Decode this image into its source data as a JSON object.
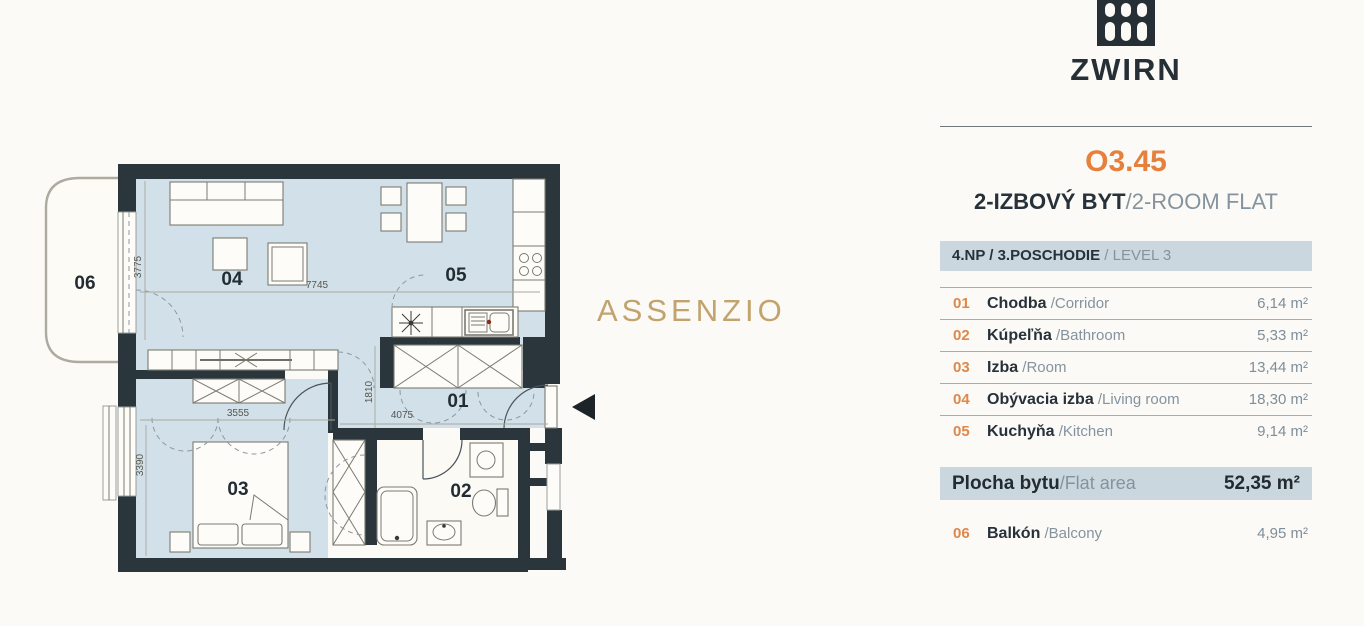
{
  "brand": {
    "name": "ZWIRN"
  },
  "unit": {
    "id": "O3.45",
    "type_sk": "2-IZBOVÝ BYT",
    "type_en": "/2-ROOM FLAT",
    "level_sk": "4.NP / 3.POSCHODIE",
    "level_en": " / LEVEL 3"
  },
  "rooms": [
    {
      "num": "01",
      "name_sk": "Chodba",
      "name_en": " /Corridor",
      "area": "6,14 m²"
    },
    {
      "num": "02",
      "name_sk": "Kúpeľňa",
      "name_en": " /Bathroom",
      "area": "5,33 m²"
    },
    {
      "num": "03",
      "name_sk": "Izba",
      "name_en": " /Room",
      "area": "13,44 m²"
    },
    {
      "num": "04",
      "name_sk": "Obývacia izba",
      "name_en": " /Living room",
      "area": "18,30 m²"
    },
    {
      "num": "05",
      "name_sk": "Kuchyňa",
      "name_en": " /Kitchen",
      "area": "9,14 m²"
    }
  ],
  "total": {
    "label_sk": "Plocha bytu",
    "label_en": " /Flat area",
    "area": "52,35 m²"
  },
  "balcony_row": {
    "num": "06",
    "name_sk": "Balkón",
    "name_en": " /Balcony",
    "area": "4,95 m²"
  },
  "watermark": "ASSENZIO",
  "plan": {
    "room_labels": {
      "r01": "01",
      "r02": "02",
      "r03": "03",
      "r04": "04",
      "r05": "05",
      "r06": "06"
    },
    "dimensions": {
      "living_width": "7745",
      "living_height": "3775",
      "bedroom_width": "3555",
      "bedroom_height": "3390",
      "corridor_height": "1810",
      "corridor_width": "4075"
    }
  },
  "colors": {
    "accent_orange": "#e5813d",
    "wall": "#2b363c",
    "floor_blue": "#d1e0e9",
    "bar_background": "#cbd7df",
    "watermark_gold": "#c2a36e"
  }
}
